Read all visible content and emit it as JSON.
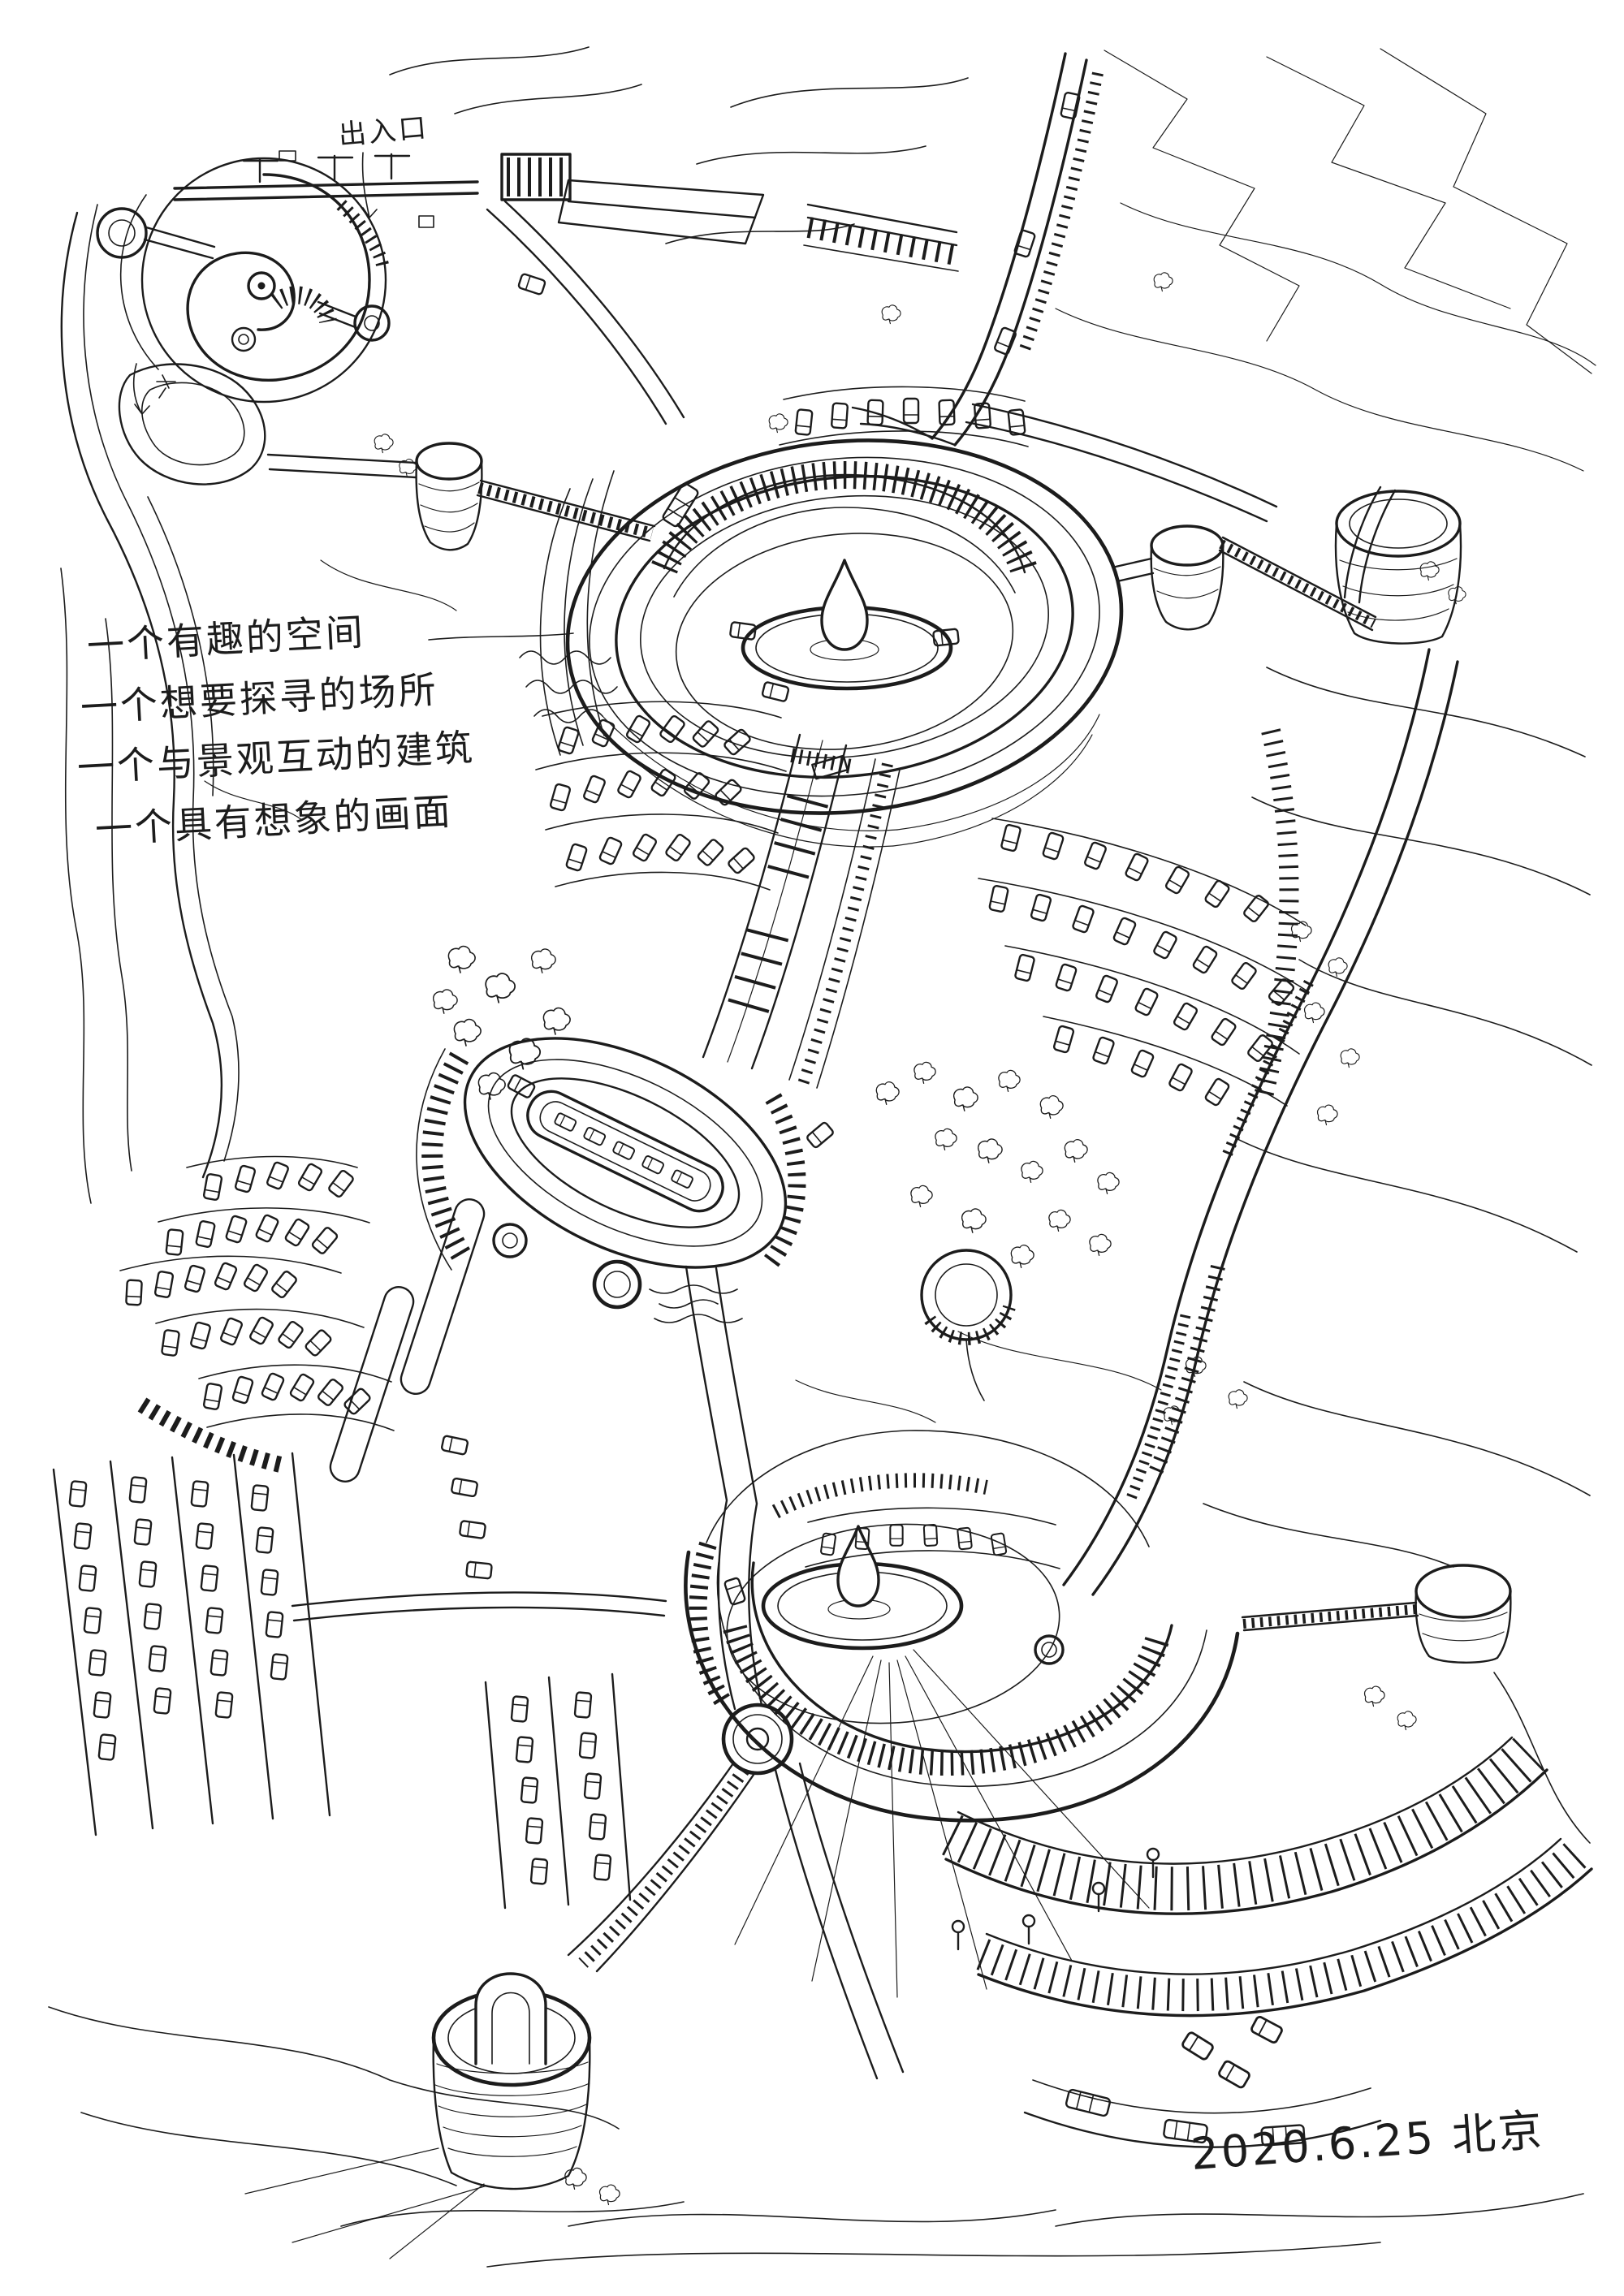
{
  "drawing": {
    "notes": [
      "一个有趣的空间",
      "一个想要探寻的场所",
      "一个与景观互动的建筑",
      "一个具有想象的画面"
    ],
    "entrance_label": "出入口",
    "signature": "2020.6.25 北京",
    "colors": {
      "ink": "#1c1c1c",
      "paper": "#ffffff"
    }
  }
}
